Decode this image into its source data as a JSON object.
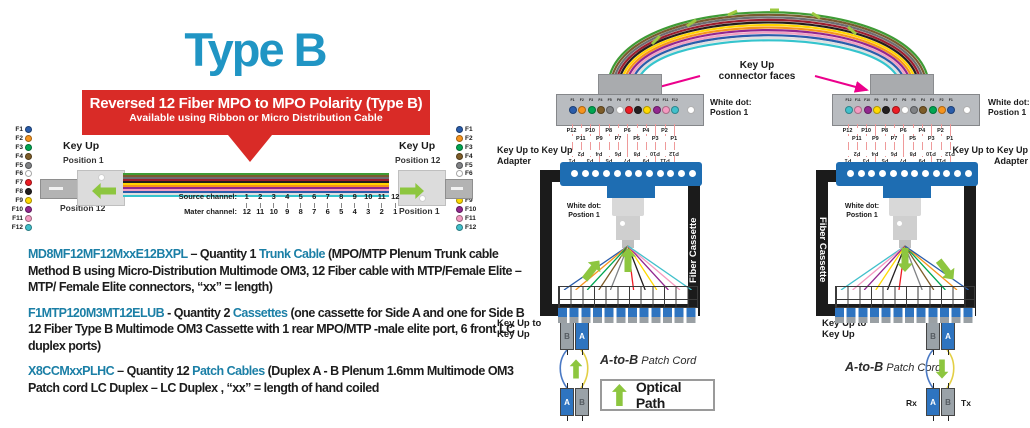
{
  "title": "Type B",
  "banner": {
    "line1": "Reversed 12 Fiber MPO to MPO Polarity (Type B)",
    "line2": "Available using Ribbon or Micro Distribution Cable"
  },
  "colors": {
    "title_teal": "#2095c4",
    "part_teal": "#1b7fa6",
    "banner_red": "#d92b27",
    "magenta_arrow": "#ec008c",
    "optical_green": "#8dc63f",
    "adapter_blue": "#1e6db2",
    "lc_blue": "#2e74c0",
    "cassette_black": "#1b1b1b"
  },
  "fibers": [
    {
      "label": "F1",
      "color": "#2a5caa"
    },
    {
      "label": "F2",
      "color": "#f7941d"
    },
    {
      "label": "F3",
      "color": "#00a651"
    },
    {
      "label": "F4",
      "color": "#7d5c28"
    },
    {
      "label": "F5",
      "color": "#808285"
    },
    {
      "label": "F6",
      "color": "#ffffff"
    },
    {
      "label": "F7",
      "color": "#ed1c24"
    },
    {
      "label": "F8",
      "color": "#231f20"
    },
    {
      "label": "F9",
      "color": "#ffd900"
    },
    {
      "label": "F10",
      "color": "#92278f"
    },
    {
      "label": "F11",
      "color": "#f49ac1"
    },
    {
      "label": "F12",
      "color": "#41c0cb"
    }
  ],
  "cable_colors": [
    "#3f9b35",
    "#7a5b2f",
    "#6d6e71",
    "#9c1f2e",
    "#231f20",
    "#ffd400",
    "#f7941d",
    "#92278f",
    "#f2a0c0",
    "#2a5caa",
    "#e0e0e0",
    "#35c4cd"
  ],
  "trunk": {
    "left": {
      "key_up": "Key Up",
      "pos_top": "Position 1",
      "pos_bottom": "Position 12"
    },
    "right": {
      "key_up": "Key Up",
      "pos_top": "Position 12",
      "pos_bottom": "Position 1"
    },
    "source_label": "Source channel:",
    "mater_label": "Mater channel:",
    "source_channels": [
      1,
      2,
      3,
      4,
      5,
      6,
      7,
      8,
      9,
      10,
      11,
      12
    ],
    "mater_channels": [
      12,
      11,
      10,
      9,
      8,
      7,
      6,
      5,
      4,
      3,
      2,
      1
    ]
  },
  "paragraphs": [
    {
      "part": "MD8MF12MF12MxxE12BXPL",
      "sep": " – ",
      "qty": "Quantity 1 ",
      "highlight": "Trunk Cable",
      "rest": " (MPO/MTP Plenum Trunk cable Method B using Micro-Distribution Multimode OM3, 12 Fiber cable with MTP/Female Elite – MTP/ Female Elite connectors, “xx” = length)"
    },
    {
      "part": "F1MTP120M3MT12ELUB",
      "sep": " - ",
      "qty": "Quantity 2 ",
      "highlight": "Cassettes",
      "rest": " (one cassette for Side A and one for Side B 12 Fiber Type B Multimode OM3 Cassette with 1 rear MPO/MTP -male elite port, 6 front LC duplex ports)"
    },
    {
      "part": "X8CCMxxPLHC",
      "sep": " – ",
      "qty": "Quantity 12 ",
      "highlight": "Patch Cables",
      "rest": " (Duplex A - B Plenum 1.6mm Multimode OM3 Patch cord LC Duplex – LC Duplex , “xx” = length of hand coiled"
    }
  ],
  "rd": {
    "key_up_faces_1": "Key Up",
    "key_up_faces_2": "connector faces",
    "white_dot": "White dot:",
    "postion": "Postion 1",
    "adapter_line1": "Key Up to Key Up",
    "adapter_line2": "Adapter",
    "fiber_cassette": "Fiber Cassette",
    "key_up_to": "Key Up to",
    "key_up": "Key Up",
    "ab": "A-to-B",
    "patch_cord": " Patch Cord",
    "optical_path": "Optical Path",
    "rx": "Rx",
    "tx": "Tx",
    "conn_labels": [
      "F1",
      "F2",
      "F3",
      "F4",
      "F5",
      "F6",
      "F7",
      "F8",
      "F9",
      "F10",
      "F11",
      "F12"
    ],
    "pos_front_upper": [
      "P12",
      "P10",
      "P8",
      "P6",
      "P4",
      "P2"
    ],
    "pos_front_lower": [
      "P11",
      "P9",
      "P7",
      "P5",
      "P3",
      "P1"
    ],
    "pos_rear_upper": [
      "P2",
      "P4",
      "P6",
      "P8",
      "P10",
      "P12"
    ],
    "pos_rear_lower": [
      "P1",
      "P3",
      "P5",
      "P7",
      "P9",
      "P11"
    ],
    "duplex_top": [
      "B",
      "A"
    ],
    "duplex_bottom": [
      "A",
      "B"
    ]
  }
}
